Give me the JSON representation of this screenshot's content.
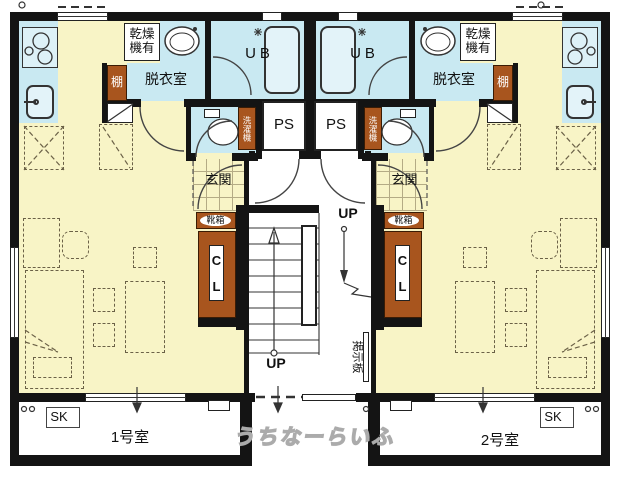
{
  "plan": {
    "unit_bath_label": "UB",
    "pipe_space_label": "PS",
    "entrance_label": "玄関",
    "dressing_room_label": "脱衣室",
    "dryer_available_label": "乾燥機有",
    "shelf_label": "棚",
    "washing_machine_label": "洗濯機",
    "shoe_box_label": "靴箱",
    "closet_label": "CL",
    "up_label": "UP",
    "bulletin_board_label": "掲示板",
    "slop_sink_label": "SK",
    "room1_label": "1号室",
    "room2_label": "2号室"
  },
  "watermark": "うちなーらいふ",
  "colors": {
    "wall": "#141414",
    "floor_yellow": "#F8F4C6",
    "wet_area_blue": "#C9E9F2",
    "cabinet_brown": "#A8551E",
    "watermark_gray": "#ababab"
  }
}
